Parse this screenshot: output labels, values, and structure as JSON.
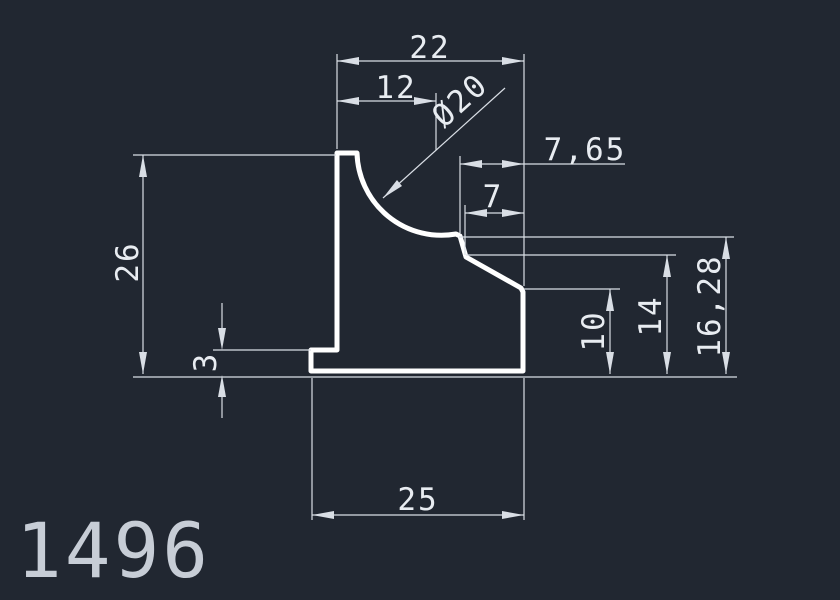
{
  "drawing": {
    "part_number": "1496",
    "dims": {
      "width_top": "22",
      "width_partial": "12",
      "cove_diameter": "Ø20",
      "offset_765": "7,65",
      "offset_7": "7",
      "height_26": "26",
      "lip_height_3": "3",
      "height_10": "10",
      "height_14": "14",
      "height_1628": "16,28",
      "width_bottom": "25"
    }
  },
  "colors": {
    "background": "#212731",
    "profile_line": "#ffffff",
    "dimension_line": "#d9dee5",
    "dimension_text": "#e8ecf1",
    "part_number_text": "#c7cdd6"
  }
}
